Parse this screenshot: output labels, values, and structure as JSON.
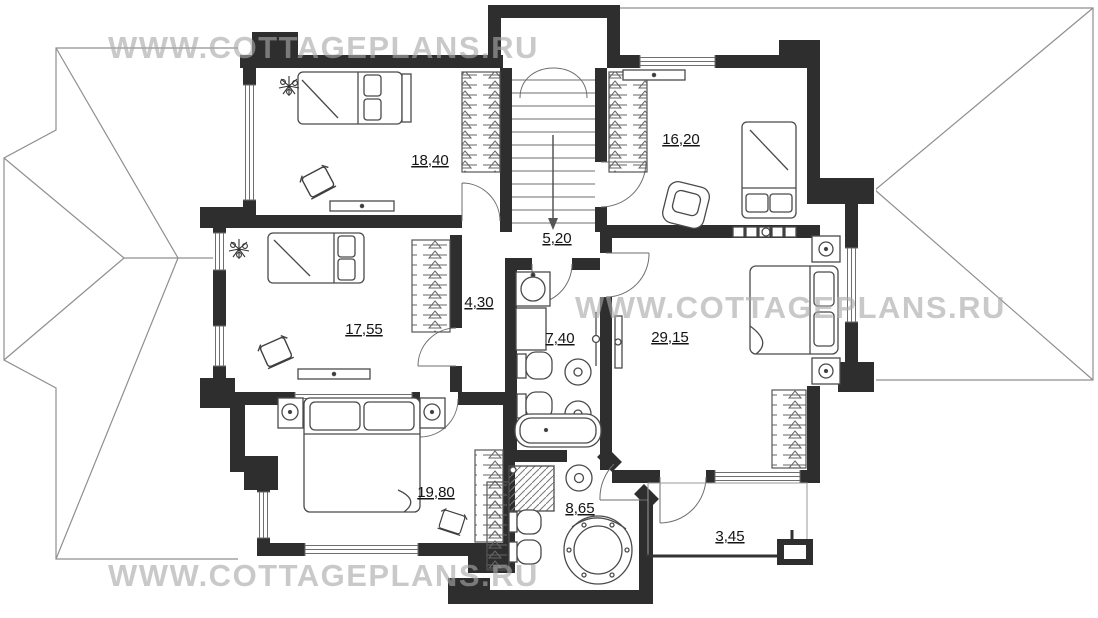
{
  "watermark": {
    "text": "WWW.COTTAGEPLANS.RU"
  },
  "plan": {
    "rooms": [
      {
        "id": "bedroom-top-left",
        "area": "18,40"
      },
      {
        "id": "bedroom-top-right",
        "area": "16,20"
      },
      {
        "id": "stair-hall",
        "area": "5,20"
      },
      {
        "id": "corridor",
        "area": "4,30"
      },
      {
        "id": "bathroom-main",
        "area": "7,40"
      },
      {
        "id": "bedroom-left",
        "area": "17,55"
      },
      {
        "id": "master-bedroom",
        "area": "29,15"
      },
      {
        "id": "bedroom-bottom",
        "area": "19,80"
      },
      {
        "id": "bathroom-spa",
        "area": "8,65"
      },
      {
        "id": "balcony",
        "area": "3,45"
      }
    ],
    "colors": {
      "wall": "#2e2e2e",
      "roof_line": "#8f8f8f",
      "watermark": "#a9a9a9",
      "furniture_line": "#4a4a4a"
    }
  }
}
